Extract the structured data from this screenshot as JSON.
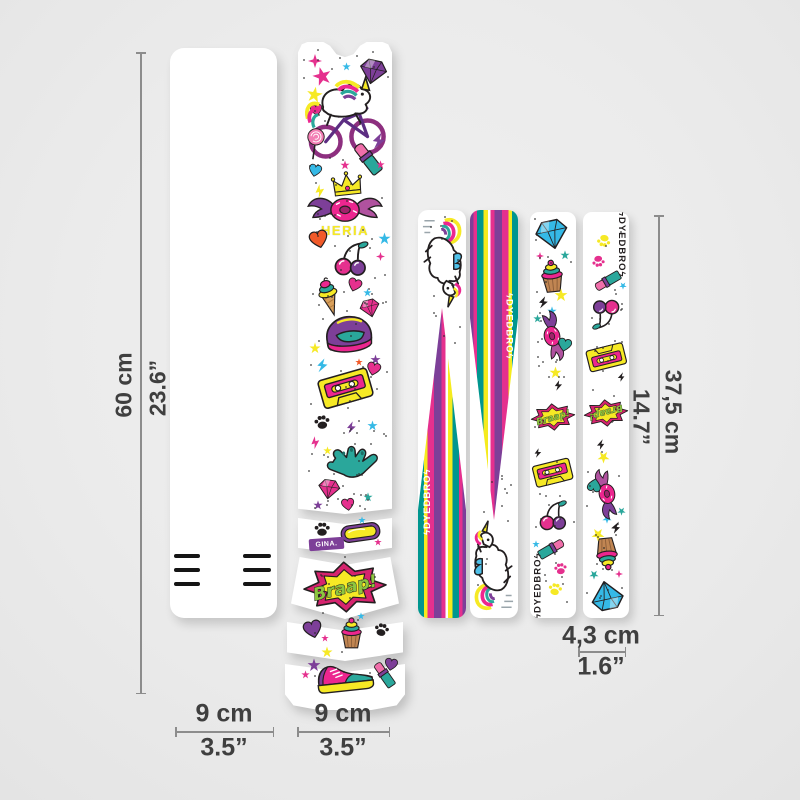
{
  "background": "#ececec",
  "brand": {
    "name": "DYEDBRO",
    "bolt": "ϟ"
  },
  "dimensions": {
    "left_height": {
      "metric": "60 cm",
      "imperial": "23.6”"
    },
    "right_height": {
      "metric": "37,5 cm",
      "imperial": "14.7”"
    },
    "front_width": {
      "metric": "9 cm",
      "imperial": "3.5”"
    },
    "frame_width": {
      "metric": "9 cm",
      "imperial": "3.5”"
    },
    "stay_width": {
      "metric": "4,3 cm",
      "imperial": "1.6”"
    }
  },
  "artwork": {
    "braap_text": "Braap!",
    "name_text": "HERIA",
    "badge_text": "GINA.",
    "palette": {
      "magenta": "#e5308e",
      "purple": "#7d3f98",
      "teal": "#2aa79b",
      "cyan": "#35b9e6",
      "yellow": "#f6e925",
      "orange": "#f15a29",
      "black": "#231f20",
      "green": "#8dc63f",
      "white": "#ffffff"
    },
    "strip2_deco": [
      [
        "sparkle",
        10,
        12,
        14,
        14,
        0,
        "magenta"
      ],
      [
        "star",
        14,
        24,
        20,
        20,
        -15,
        "magenta"
      ],
      [
        "star",
        8,
        44,
        17,
        17,
        10,
        "yellow"
      ],
      [
        "heart",
        12,
        62,
        13,
        13,
        -10,
        "magenta"
      ],
      [
        "gem",
        60,
        16,
        30,
        27,
        12,
        "purple"
      ],
      [
        "unicornbike",
        2,
        28,
        90,
        92,
        0,
        ""
      ],
      [
        "star",
        44,
        20,
        9,
        9,
        0,
        "cyan"
      ],
      [
        "lollipop",
        6,
        84,
        22,
        36,
        8,
        ""
      ],
      [
        "bolt",
        72,
        90,
        18,
        18,
        10,
        "purple"
      ],
      [
        "lipstick",
        56,
        98,
        28,
        38,
        -38,
        ""
      ],
      [
        "star",
        42,
        118,
        10,
        10,
        0,
        "magenta"
      ],
      [
        "heart",
        10,
        122,
        14,
        14,
        12,
        "cyan"
      ],
      [
        "bolt",
        15,
        142,
        14,
        14,
        -12,
        "yellow"
      ],
      [
        "crown",
        32,
        128,
        34,
        27,
        -6,
        ""
      ],
      [
        "star",
        78,
        118,
        9,
        9,
        0,
        "magenta"
      ],
      [
        "wingdonut",
        9,
        150,
        76,
        33,
        0,
        ""
      ],
      [
        "name",
        16,
        181,
        62,
        15,
        0,
        ""
      ],
      [
        "star",
        80,
        190,
        13,
        13,
        0,
        "cyan"
      ],
      [
        "heart",
        11,
        188,
        20,
        20,
        -14,
        "orange"
      ],
      [
        "cherries",
        31,
        198,
        44,
        38,
        0,
        ""
      ],
      [
        "sparkle",
        78,
        210,
        9,
        9,
        0,
        "magenta"
      ],
      [
        "icecream",
        11,
        234,
        40,
        42,
        -16,
        ""
      ],
      [
        "heart",
        49,
        236,
        15,
        15,
        18,
        "magenta"
      ],
      [
        "star",
        65,
        246,
        9,
        9,
        0,
        "cyan"
      ],
      [
        "gem",
        61,
        256,
        22,
        20,
        -14,
        "magenta"
      ],
      [
        "helmet",
        21,
        270,
        60,
        48,
        -6,
        ""
      ],
      [
        "star",
        11,
        300,
        12,
        12,
        0,
        "yellow"
      ],
      [
        "star",
        72,
        312,
        11,
        11,
        0,
        "purple"
      ],
      [
        "bolt",
        17,
        316,
        15,
        15,
        8,
        "cyan"
      ],
      [
        "heart",
        68,
        320,
        15,
        15,
        14,
        "magenta"
      ],
      [
        "star",
        57,
        316,
        8,
        8,
        0,
        "orange"
      ],
      [
        "cassette",
        21,
        328,
        54,
        40,
        -16,
        ""
      ],
      [
        "paw",
        15,
        372,
        18,
        17,
        -8,
        "black"
      ],
      [
        "bolt",
        47,
        376,
        13,
        19,
        4,
        "purple"
      ],
      [
        "star",
        69,
        378,
        11,
        11,
        0,
        "cyan"
      ],
      [
        "bolt",
        11,
        394,
        13,
        13,
        -14,
        "magenta"
      ],
      [
        "star",
        25,
        404,
        9,
        9,
        0,
        "yellow"
      ],
      [
        "shaka",
        22,
        400,
        62,
        45,
        -4,
        ""
      ],
      [
        "gem",
        19,
        436,
        24,
        22,
        8,
        "magenta"
      ],
      [
        "star",
        65,
        450,
        10,
        10,
        0,
        "teal"
      ],
      [
        "heart",
        43,
        456,
        14,
        14,
        -8,
        "magenta"
      ],
      [
        "star",
        15,
        458,
        10,
        10,
        0,
        "purple"
      ],
      [
        "paw",
        15,
        479,
        18,
        17,
        0,
        "black"
      ],
      [
        "star",
        60,
        474,
        8,
        8,
        0,
        "cyan"
      ],
      [
        "goggles",
        41,
        477,
        43,
        27,
        -8,
        ""
      ],
      [
        "badge",
        11,
        496,
        35,
        12,
        -4,
        ""
      ],
      [
        "star",
        76,
        496,
        8,
        8,
        0,
        "magenta"
      ],
      [
        "braap",
        3,
        518,
        88,
        54,
        -3,
        ""
      ],
      [
        "heart",
        5,
        578,
        20,
        20,
        -14,
        "purple"
      ],
      [
        "star",
        59,
        570,
        8,
        8,
        0,
        "cyan"
      ],
      [
        "cupcake",
        35,
        572,
        37,
        36,
        0,
        ""
      ],
      [
        "paw",
        75,
        580,
        17,
        16,
        12,
        "black"
      ],
      [
        "star",
        23,
        592,
        8,
        8,
        0,
        "magenta"
      ],
      [
        "star",
        23,
        604,
        12,
        12,
        0,
        "yellow"
      ],
      [
        "star",
        9,
        616,
        14,
        14,
        0,
        "purple"
      ],
      [
        "star",
        3,
        628,
        9,
        9,
        0,
        "magenta"
      ],
      [
        "sneaker",
        15,
        616,
        64,
        36,
        -6,
        ""
      ],
      [
        "lipstick",
        75,
        618,
        23,
        30,
        -35,
        ""
      ],
      [
        "heart",
        86,
        616,
        14,
        14,
        10,
        "purple"
      ]
    ],
    "strip5_deco": [
      [
        "gem",
        4,
        6,
        36,
        32,
        -12,
        "cyan"
      ],
      [
        "star",
        30,
        38,
        10,
        10,
        0,
        "teal"
      ],
      [
        "sparkle",
        6,
        40,
        8,
        8,
        0,
        "magenta"
      ],
      [
        "cupcake",
        2,
        44,
        40,
        38,
        -6,
        ""
      ],
      [
        "star",
        24,
        76,
        14,
        14,
        0,
        "yellow"
      ],
      [
        "bolt",
        7,
        84,
        13,
        13,
        8,
        "black"
      ],
      [
        "star",
        17,
        94,
        10,
        10,
        0,
        "cyan"
      ],
      [
        "star",
        3,
        102,
        9,
        9,
        0,
        "teal"
      ],
      [
        "wingdonut",
        -3,
        112,
        52,
        24,
        78,
        ""
      ],
      [
        "heart",
        27,
        126,
        15,
        15,
        12,
        "teal"
      ],
      [
        "star",
        19,
        154,
        13,
        13,
        0,
        "yellow"
      ],
      [
        "bolt",
        23,
        168,
        11,
        11,
        0,
        "black"
      ],
      [
        "braap",
        0,
        184,
        46,
        42,
        -6,
        ""
      ],
      [
        "bolt",
        3,
        236,
        10,
        10,
        0,
        "black"
      ],
      [
        "cassette",
        3,
        246,
        40,
        32,
        -14,
        ""
      ],
      [
        "cherries",
        5,
        288,
        36,
        32,
        -4,
        ""
      ],
      [
        "star",
        2,
        328,
        8,
        8,
        0,
        "cyan"
      ],
      [
        "lipstick",
        8,
        322,
        26,
        30,
        60,
        ""
      ],
      [
        "paw",
        23,
        350,
        15,
        14,
        -8,
        "magenta"
      ],
      [
        "paw",
        17,
        370,
        16,
        15,
        10,
        "yellow"
      ],
      [
        "brand",
        2,
        348,
        12,
        52,
        0,
        "black"
      ]
    ]
  }
}
